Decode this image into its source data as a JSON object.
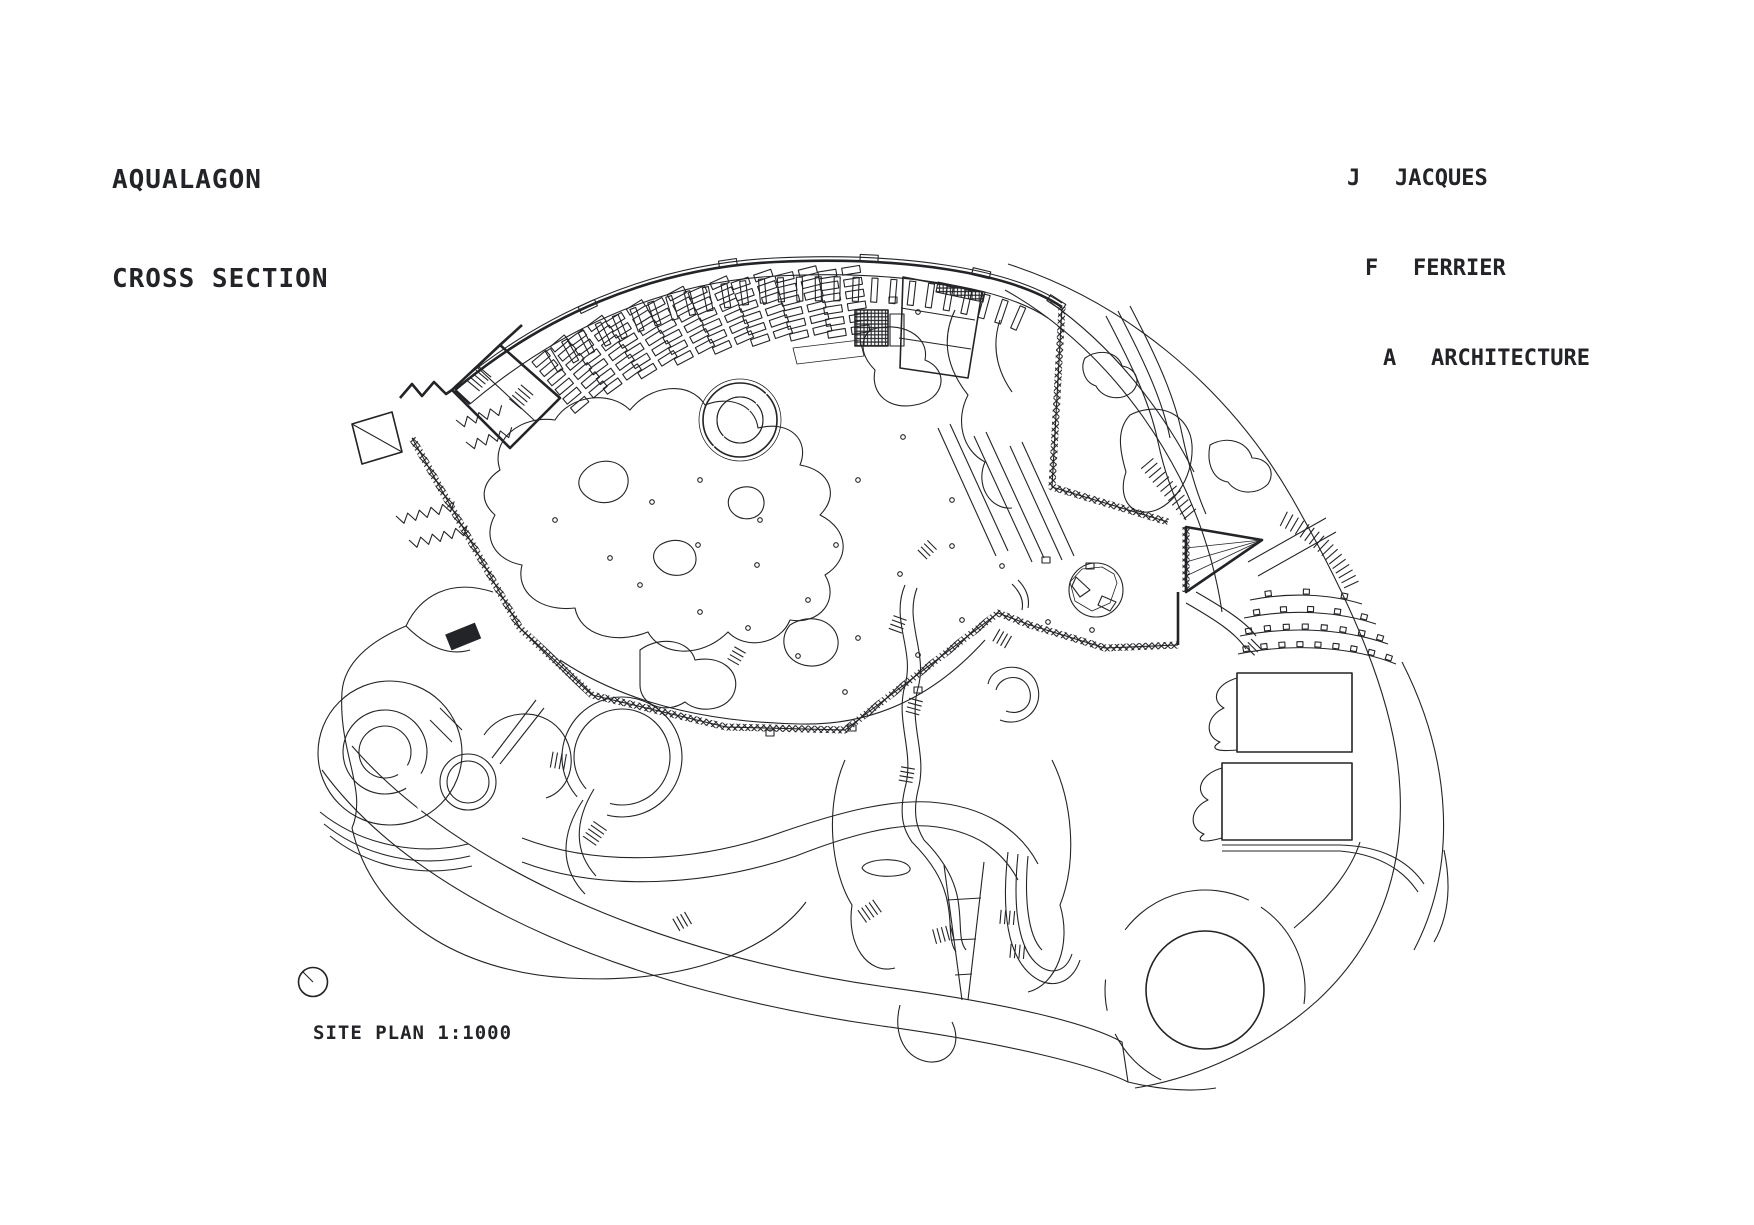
{
  "colors": {
    "background": "#ffffff",
    "ink": "#232427"
  },
  "title": {
    "line1": "AQUALAGON",
    "line2": "CROSS SECTION"
  },
  "attribution": {
    "lines": [
      {
        "initial": "J",
        "word": "JACQUES"
      },
      {
        "initial": "F",
        "word": "FERRIER"
      },
      {
        "initial": "A",
        "word": "ARCHITECTURE"
      }
    ]
  },
  "scale": {
    "label": "SITE PLAN 1:1000"
  }
}
